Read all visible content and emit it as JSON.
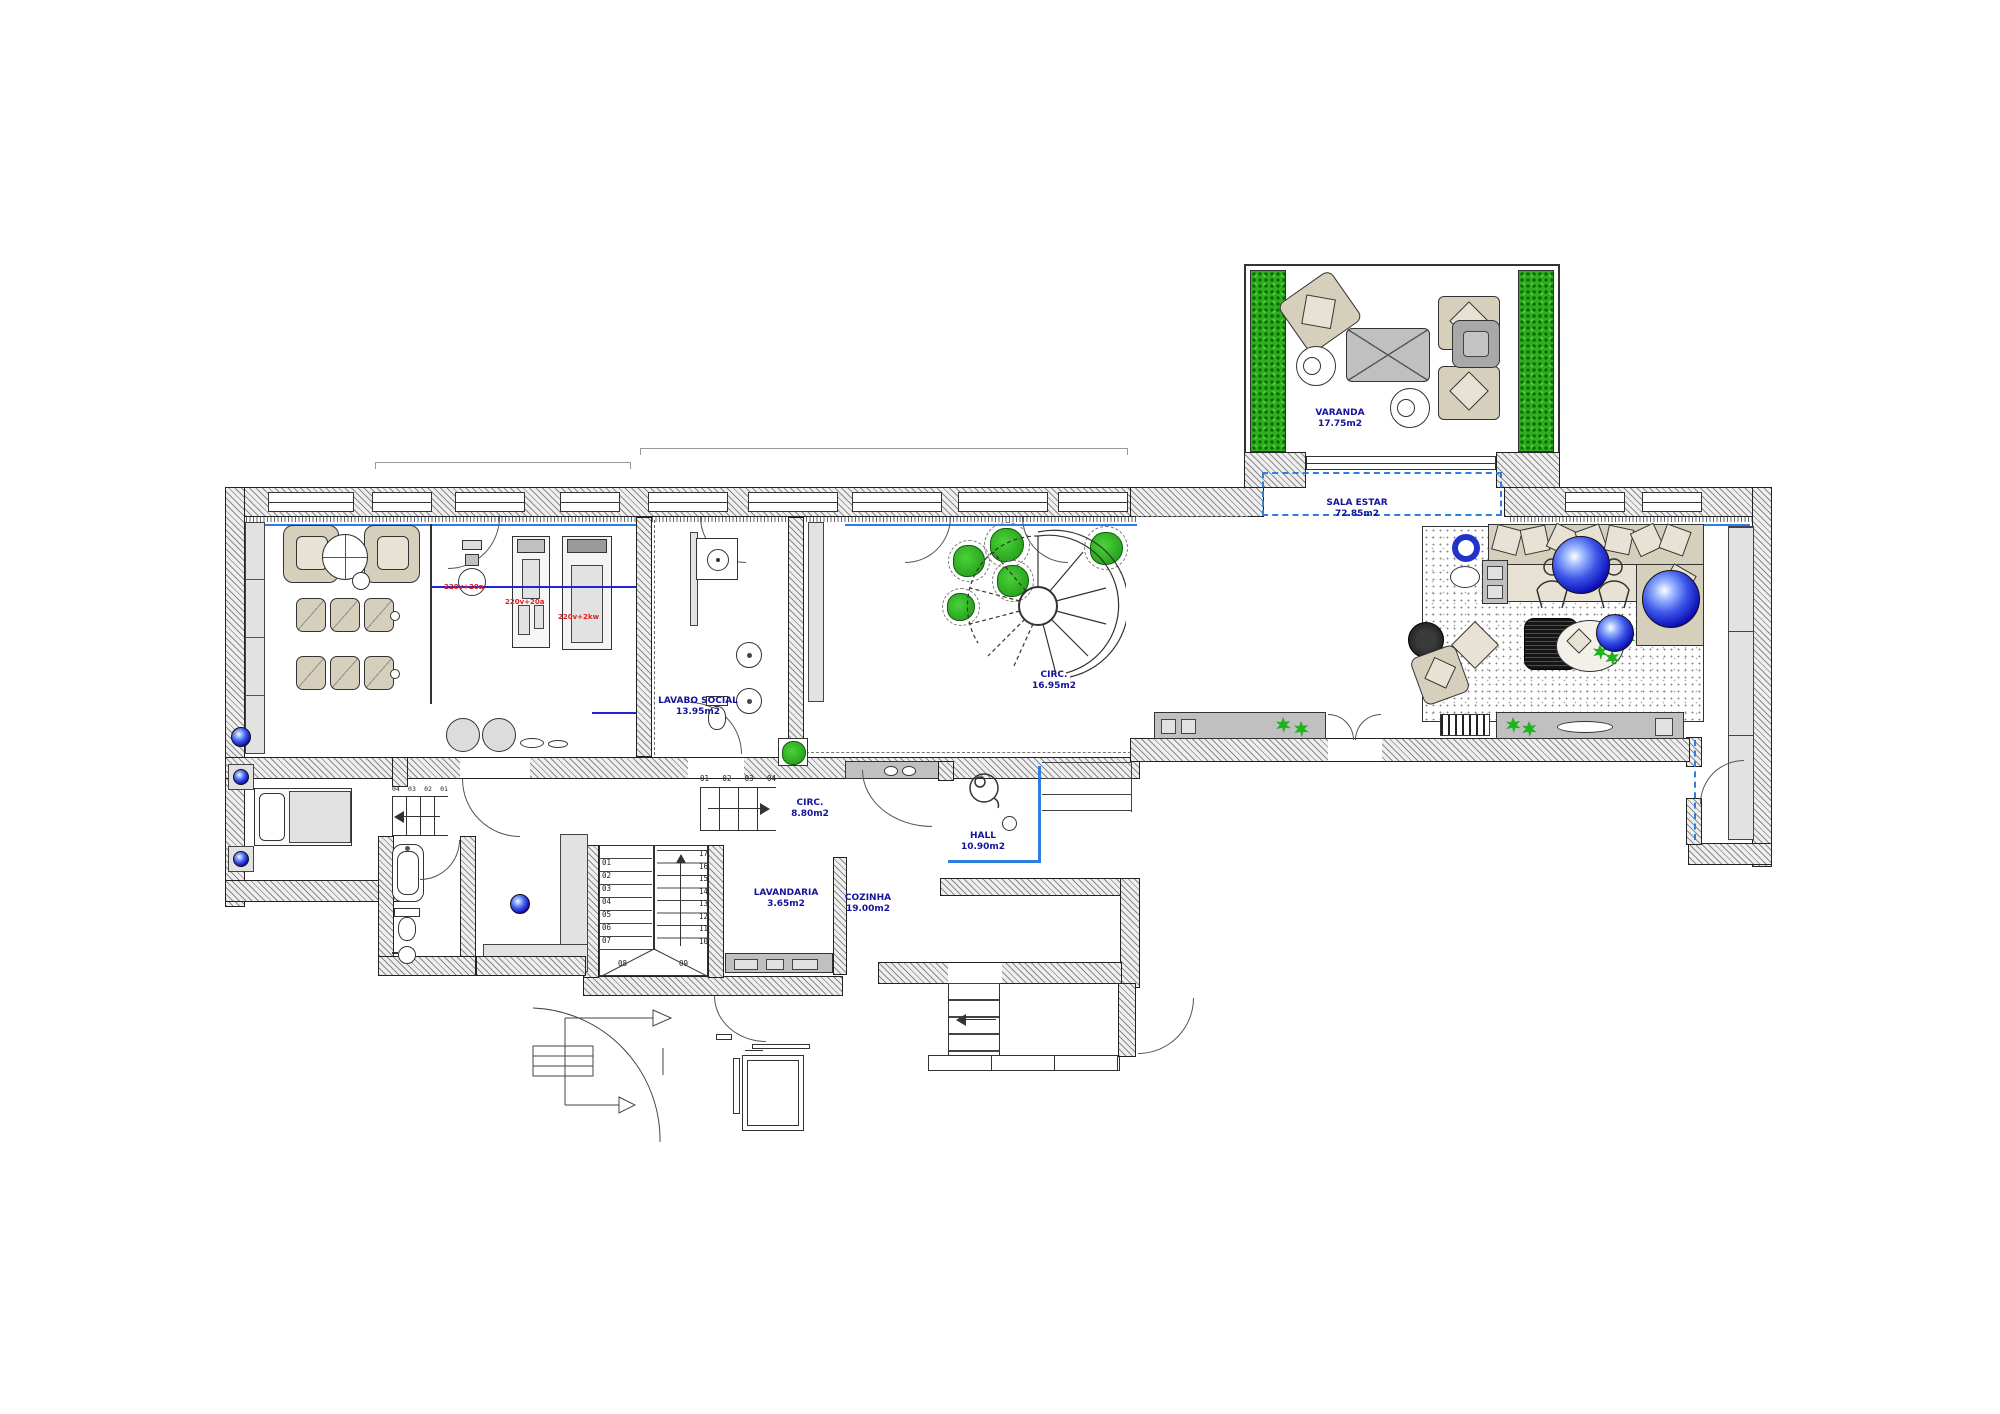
{
  "plan": {
    "rooms": {
      "varanda": {
        "name": "VARANDA",
        "area": "17.75m2"
      },
      "sala_estar": {
        "name": "SALA ESTAR",
        "area": "72.85m2"
      },
      "circ_escada": {
        "name": "CIRC.",
        "area": "16.95m2"
      },
      "lavabo_social": {
        "name": "LAVABO SOCIAL",
        "area": "13.95m2"
      },
      "circ_servico": {
        "name": "CIRC.",
        "area": "8.80m2"
      },
      "hall": {
        "name": "HALL",
        "area": "10.90m2"
      },
      "lavandaria": {
        "name": "LAVANDARIA",
        "area": "3.65m2"
      },
      "cozinha": {
        "name": "COZINHA",
        "area": "19.00m2"
      }
    },
    "equipment_notes": [
      "220v+20a",
      "220v+20a",
      "220v+2kw"
    ],
    "stairs": {
      "main_left": [
        "01",
        "02",
        "03",
        "04",
        "05",
        "06",
        "07"
      ],
      "main_bottom": [
        "08",
        "09"
      ],
      "main_right": [
        "17",
        "16",
        "15",
        "14",
        "13",
        "12",
        "11",
        "10"
      ],
      "circ_steps": [
        "01",
        "02",
        "03",
        "04"
      ],
      "bedroom_steps": [
        "04",
        "03",
        "02",
        "01"
      ]
    },
    "colors": {
      "accent_blue": "#2b7fe0",
      "label_navy": "#14149b",
      "plant_green": "#2fae1e",
      "power_red": "#e02020",
      "furniture_beige": "#d6cfbc"
    }
  }
}
